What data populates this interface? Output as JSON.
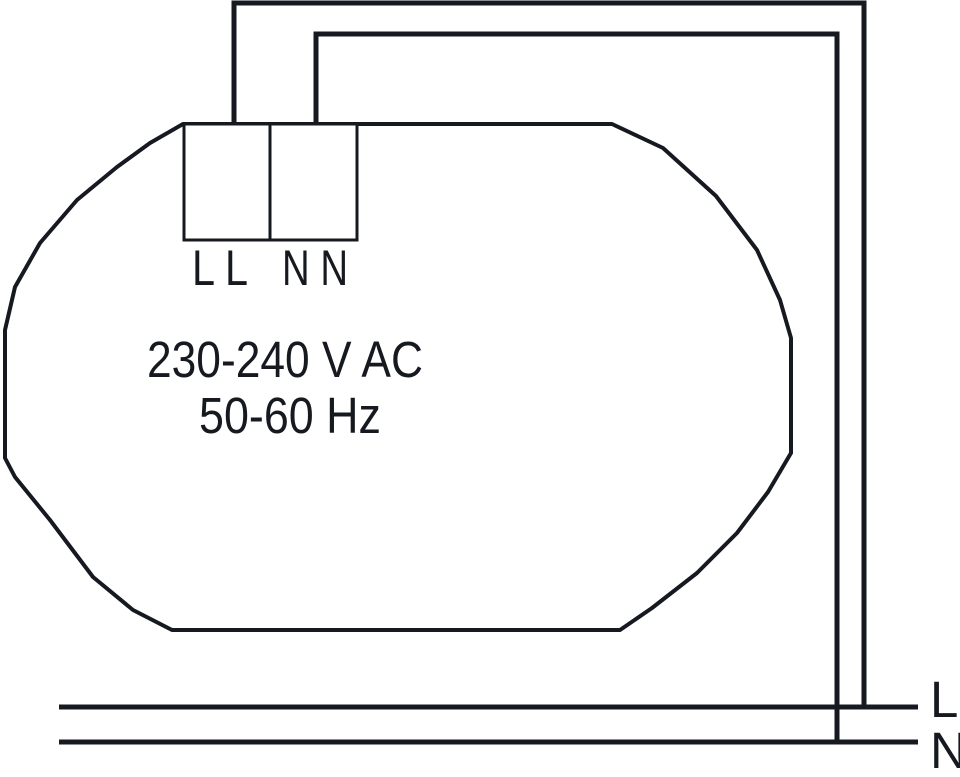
{
  "colors": {
    "ink": "#161a20",
    "background": "#ffffff"
  },
  "device": {
    "voltage": "230-240 V AC",
    "frequency": "50-60 Hz",
    "terminals": {
      "live": "L L",
      "neutral": "N N"
    }
  },
  "supply": {
    "live": "L",
    "neutral": "N"
  }
}
